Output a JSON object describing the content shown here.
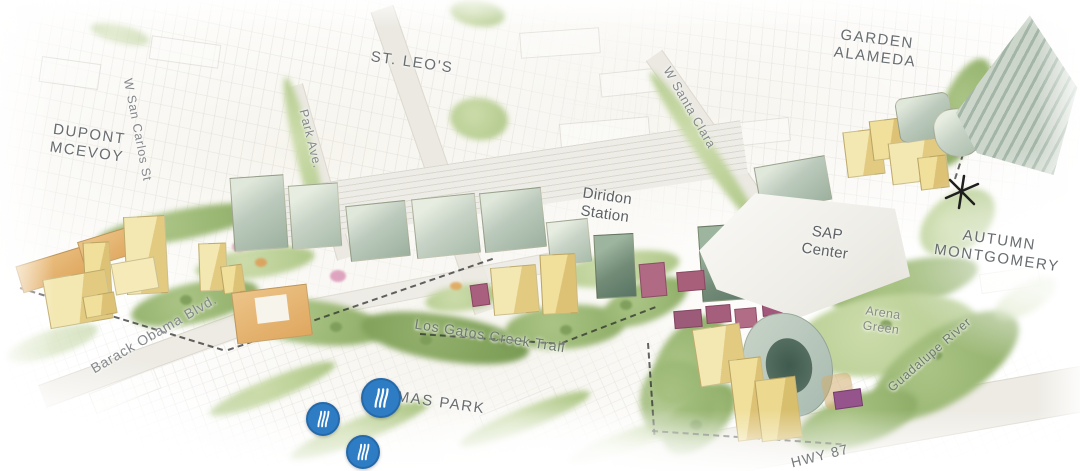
{
  "map": {
    "district_labels": [
      {
        "id": "dupont-mcevoy",
        "text": "DUPONT\nMCEVOY"
      },
      {
        "id": "st-leos",
        "text": "ST. LEO'S"
      },
      {
        "id": "garden-alameda",
        "text": "GARDEN\nALAMEDA"
      },
      {
        "id": "autumn-montgomery",
        "text": "AUTUMN\nMONTGOMERY"
      },
      {
        "id": "delmas-park",
        "text": "DELMAS PARK"
      }
    ],
    "place_labels": [
      {
        "id": "diridon-station",
        "text": "Diridon\nStation"
      },
      {
        "id": "sap-center",
        "text": "SAP\nCenter"
      },
      {
        "id": "arena-green",
        "text": "Arena\nGreen"
      }
    ],
    "street_labels": [
      {
        "id": "w-san-carlos",
        "text": "W San Carlos St"
      },
      {
        "id": "park-ave",
        "text": "Park Ave."
      },
      {
        "id": "w-santa-clara",
        "text": "W Santa Clara"
      },
      {
        "id": "barack-obama-blvd",
        "text": "Barack Obama Blvd."
      },
      {
        "id": "los-gatos-creek-trail",
        "text": "Los Gatos Creek Trail"
      },
      {
        "id": "guadalupe-river",
        "text": "Guadalupe River"
      },
      {
        "id": "hwy-87",
        "text": "HWY 87"
      }
    ],
    "markers": {
      "trail_markers": {
        "count": 3,
        "icon": "curved-lines-marker",
        "color": "#2e7cc3"
      },
      "landmark_asterisk": {
        "icon": "asterisk",
        "color": "#1f1f1f"
      }
    },
    "palette": {
      "office_sage": "#b7c6bc",
      "residential_yellow": "#f0e3a6",
      "mixed_use_tan": "#e0ac66",
      "venue_maroon": "#a95f7e",
      "accent_purple": "#95548c",
      "landscape_green": "#a3c07e",
      "road": "#ebe9e2",
      "label_gray": "#6e7376"
    }
  }
}
